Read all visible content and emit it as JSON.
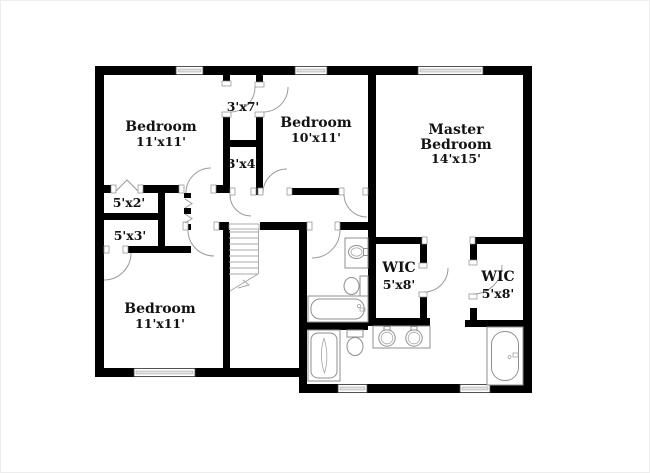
{
  "plan": {
    "type": "floor-plan",
    "background_color": "#ffffff",
    "wall_color": "#000000",
    "line_color": "#9a9a9a",
    "text_color": "#121212",
    "rooms": [
      {
        "id": "bedroom-top-left",
        "name": "Bedroom",
        "dims": "11'x11'"
      },
      {
        "id": "closet-3x7",
        "dims": "3'x7'"
      },
      {
        "id": "bedroom-top-middle",
        "name": "Bedroom",
        "dims": "10'x11'"
      },
      {
        "id": "master-bedroom",
        "name_line1": "Master",
        "name_line2": "Bedroom",
        "dims": "14'x15'"
      },
      {
        "id": "closet-3x4",
        "dims": "3'x4'"
      },
      {
        "id": "closet-5x2",
        "dims": "5'x2'"
      },
      {
        "id": "closet-5x3",
        "dims": "5'x3'"
      },
      {
        "id": "bedroom-bottom-left",
        "name": "Bedroom",
        "dims": "11'x11'"
      },
      {
        "id": "wic-left",
        "name": "WIC",
        "dims": "5'x8'"
      },
      {
        "id": "wic-right",
        "name": "WIC",
        "dims": "5'x8'"
      }
    ]
  }
}
